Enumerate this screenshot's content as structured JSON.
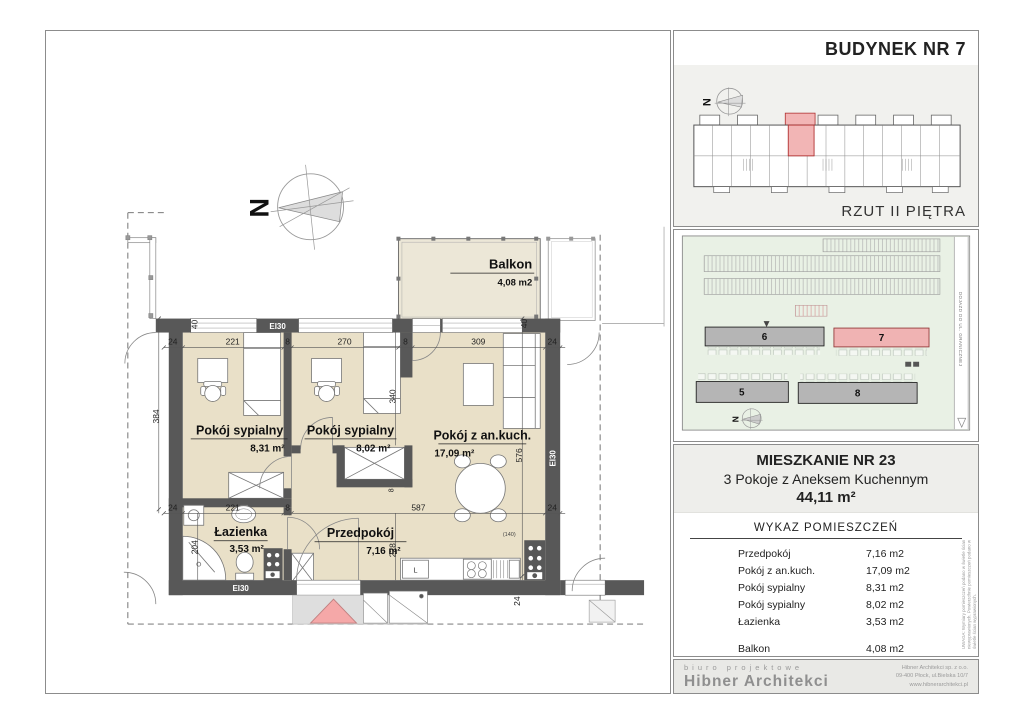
{
  "plan": {
    "north": "N",
    "balcony": {
      "name": "Balkon",
      "area": "4,08 m2"
    },
    "rooms": [
      {
        "name": "Pokój sypialny",
        "area": "8,31 m²"
      },
      {
        "name": "Pokój sypialny",
        "area": "8,02 m²"
      },
      {
        "name": "Pokój z an.kuch.",
        "area": "17,09 m²"
      },
      {
        "name": "Łazienka",
        "area": "3,53 m²"
      },
      {
        "name": "Przedpokój",
        "area": "7,16 m²"
      }
    ],
    "fire_rating_labels": [
      "EI30",
      "EI30",
      "EI30"
    ],
    "fridge_label": "L",
    "dims": {
      "top": [
        "24",
        "221",
        "8",
        "270",
        "8",
        "309",
        "24"
      ],
      "mid": [
        "24",
        "221",
        "8",
        "587",
        "24"
      ],
      "v_384": "384",
      "v_340": "340",
      "v_576": "576",
      "v_204": "204",
      "v_228": "228",
      "v_24_bottom": "24",
      "wall_40_left": "40",
      "wall_40_right": "40",
      "wall_8": "8",
      "kitchen_140": "(140)"
    }
  },
  "building_panel": {
    "title": "BUDYNEK NR 7",
    "caption": "RZUT II PIĘTRA",
    "north": "N"
  },
  "site_panel": {
    "buildings": [
      "6",
      "7",
      "5",
      "8"
    ],
    "road_label": "DOJAZD DO UL. GRANICZNEJ",
    "north": "N"
  },
  "apartment_panel": {
    "title": "MIESZKANIE NR 23",
    "subtitle": "3 Pokoje z Aneksem Kuchennym",
    "total_area": "44,11 m²",
    "list_title": "WYKAZ POMIESZCZEŃ",
    "rows": [
      {
        "name": "Przedpokój",
        "area": "7,16 m2"
      },
      {
        "name": "Pokój z an.kuch.",
        "area": "17,09 m2"
      },
      {
        "name": "Pokój sypialny",
        "area": "8,31 m2"
      },
      {
        "name": "Pokój sypialny",
        "area": "8,02 m2"
      },
      {
        "name": "Łazienka",
        "area": "3,53 m2"
      },
      {
        "name": "Balkon",
        "area": "4,08 m2"
      }
    ],
    "side_note": "UWAGA: Wymiary pomieszczeń podano w świetle ścian niewyprawionych. Powierzchnie pomieszczeń podano w świetle ścian wyprawionych."
  },
  "footer": {
    "tagline": "biuro projektowe",
    "studio": "Hibner Architekci",
    "address_lines": [
      "Hibner Architekci sp. z o.o.",
      "09-400 Płock, ul.Bielska 10/7",
      "www.hibnerarchitekci.pl"
    ]
  }
}
